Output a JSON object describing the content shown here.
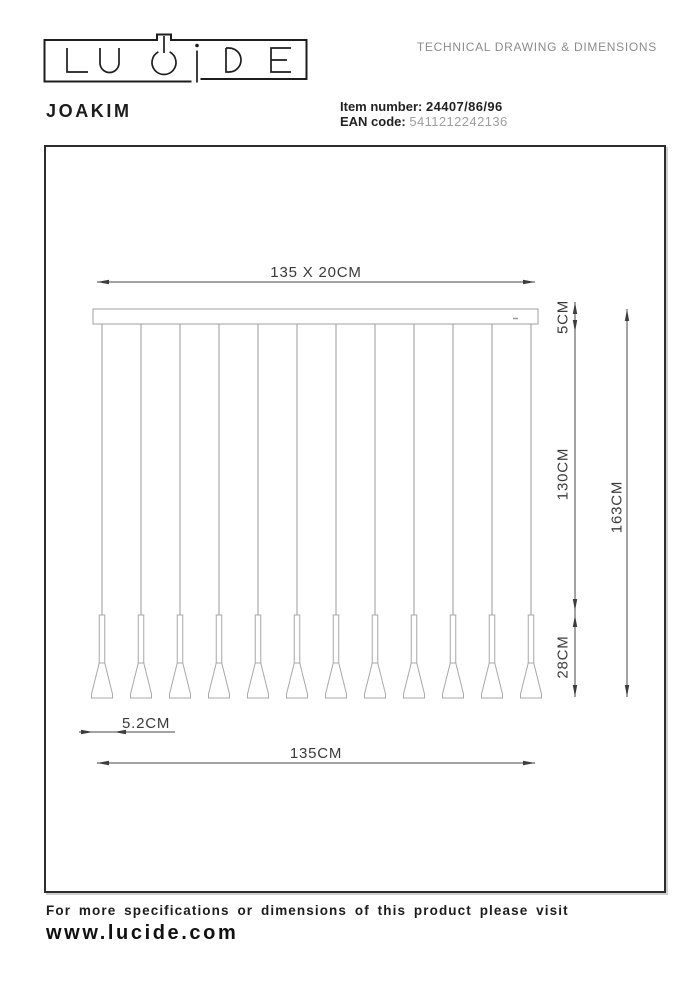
{
  "header": {
    "brand": "LUCIDE",
    "doc_title": "TECHNICAL DRAWING & DIMENSIONS",
    "product_name": "JOAKIM",
    "item_number_label": "Item number:",
    "item_number": "24407/86/96",
    "ean_label": "EAN code:",
    "ean": "5411212242136"
  },
  "drawing": {
    "pendant_count": 12,
    "dimensions": {
      "bar_width_depth": "135 X 20CM",
      "bar_height": "5CM",
      "cord_length": "130CM",
      "total_height": "163CM",
      "shade_height": "28CM",
      "shade_diameter": "5.2CM",
      "overall_width": "135CM"
    }
  },
  "footer": {
    "line1": "For more specifications or dimensions of this product please visit",
    "line2": "www.lucide.com"
  },
  "colors": {
    "text_dark": "#1c1c1c",
    "text_gray": "#8c8c8c",
    "ean_gray": "#9e9e9e",
    "drawing_gray": "#a8a8a8",
    "dimension_color": "#3d3d3d",
    "frame_border": "#2d2d2d",
    "background": "#ffffff"
  }
}
